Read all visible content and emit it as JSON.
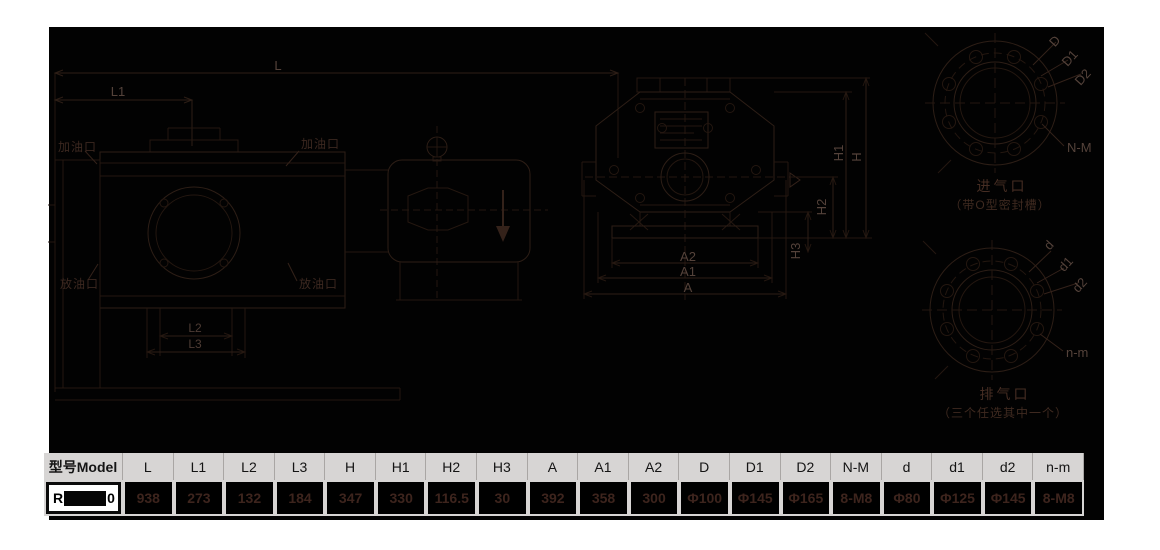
{
  "drawing": {
    "side_view": {
      "dim_L": "L",
      "dim_L1": "L1",
      "dim_L2": "L2",
      "dim_L3": "L3",
      "oil_fill_left_label": "加油口",
      "oil_fill_mid_label": "加油口",
      "oil_drain_left_label": "放油口",
      "oil_drain_mid_label": "放油口"
    },
    "end_view": {
      "dim_H": "H",
      "dim_H1": "H1",
      "dim_H2": "H2",
      "dim_H3": "H3",
      "dim_A": "A",
      "dim_A1": "A1",
      "dim_A2": "A2"
    },
    "inlet_flange": {
      "dim_D": "D",
      "dim_D1": "D1",
      "dim_D2": "D2",
      "bolt_label": "N-M",
      "caption": "进气口",
      "caption_note": "（带O型密封槽）"
    },
    "outlet_flange": {
      "dim_d": "d",
      "dim_d1": "d1",
      "dim_d2": "d2",
      "bolt_label": "n-m",
      "caption": "排气口",
      "caption_note": "（三个任选其中一个）"
    }
  },
  "table": {
    "model_header": "型号Model",
    "model_prefix": "R",
    "model_suffix": "0",
    "columns": [
      "L",
      "L1",
      "L2",
      "L3",
      "H",
      "H1",
      "H2",
      "H3",
      "A",
      "A1",
      "A2",
      "D",
      "D1",
      "D2",
      "N-M",
      "d",
      "d1",
      "d2",
      "n-m"
    ],
    "values": [
      "938",
      "273",
      "132",
      "184",
      "347",
      "330",
      "116.5",
      "30",
      "392",
      "358",
      "300",
      "Φ100",
      "Φ145",
      "Φ165",
      "8-M8",
      "Φ80",
      "Φ125",
      "Φ145",
      "8-M8"
    ]
  },
  "colors": {
    "page_background": "#ffffff",
    "drawing_background": "#020202",
    "line": "#2d1e16",
    "dim_label": "#54423a",
    "caption": "#462d23",
    "table_header_bg": "#d7d5d4",
    "table_value_text": "#3d241d"
  }
}
